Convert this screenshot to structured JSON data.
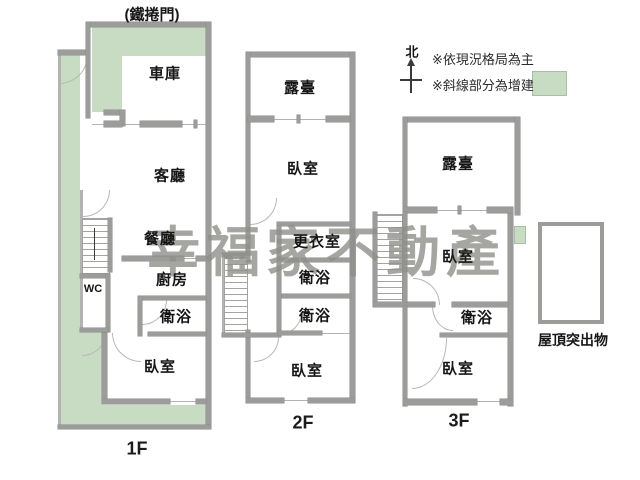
{
  "annotations": {
    "roller_door": "(鐵捲門)",
    "roof_protrusion": "屋頂突出物"
  },
  "watermark": "幸福家不動產",
  "legend": {
    "north": "北",
    "note_layout": "※依現況格局為主",
    "note_addition": "※斜線部分為增建"
  },
  "colors": {
    "addition_green": "#c8dcc3",
    "wall_gray": "#9c9c9a",
    "watermark_gray": "#8e8e8b",
    "text_dark": "#161616"
  },
  "floor1": {
    "label": "1F",
    "rooms": {
      "garage": "車庫",
      "living": "客廳",
      "dining": "餐廳",
      "kitchen": "廚房",
      "wc": "WC",
      "bath": "衛浴",
      "bedroom": "臥室"
    }
  },
  "floor2": {
    "label": "2F",
    "rooms": {
      "terrace": "露臺",
      "bedroom_front": "臥室",
      "dressing": "更衣室",
      "bath_front": "衛浴",
      "bath_rear": "衛浴",
      "bedroom_rear": "臥室"
    }
  },
  "floor3": {
    "label": "3F",
    "rooms": {
      "terrace": "露臺",
      "bedroom_front": "臥室",
      "bath": "衛浴",
      "bedroom_rear": "臥室"
    }
  }
}
